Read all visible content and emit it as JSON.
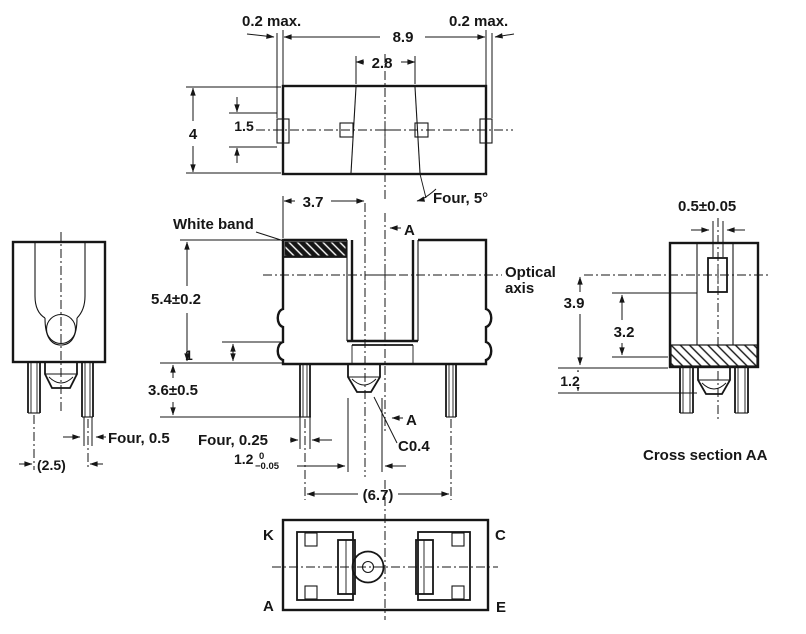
{
  "top": {
    "clearance_left": "0.2 max.",
    "clearance_right": "0.2 max.",
    "width": "8.9",
    "slot_width": "2.8",
    "depth": "4",
    "window_height": "1.5",
    "draft_note": "Four, 5°"
  },
  "front": {
    "white_band": "White band",
    "emitter_offset": "3.7",
    "section_marker": "A",
    "optical_axis_1": "Optical",
    "optical_axis_2": "axis",
    "height": "5.4±0.2",
    "step": "1",
    "lead_length": "3.6±0.5",
    "lead_width_side": "Four, 0.5",
    "lead_width_front": "Four, 0.25",
    "boss_nominal": "1.2",
    "boss_tol_up": "0",
    "boss_tol_low": "−0.05",
    "lead_span": "(6.7)",
    "chamfer": "C0.4"
  },
  "side": {
    "lead_pitch": "(2.5)"
  },
  "section": {
    "aperture": "0.5±0.05",
    "axis_height": "3.9",
    "inner_height": "3.2",
    "band_height": "1.2",
    "caption": "Cross section AA"
  },
  "bottom": {
    "k": "K",
    "c": "C",
    "a": "A",
    "e": "E"
  },
  "colors": {
    "line": "#161616",
    "background": "#ffffff"
  }
}
